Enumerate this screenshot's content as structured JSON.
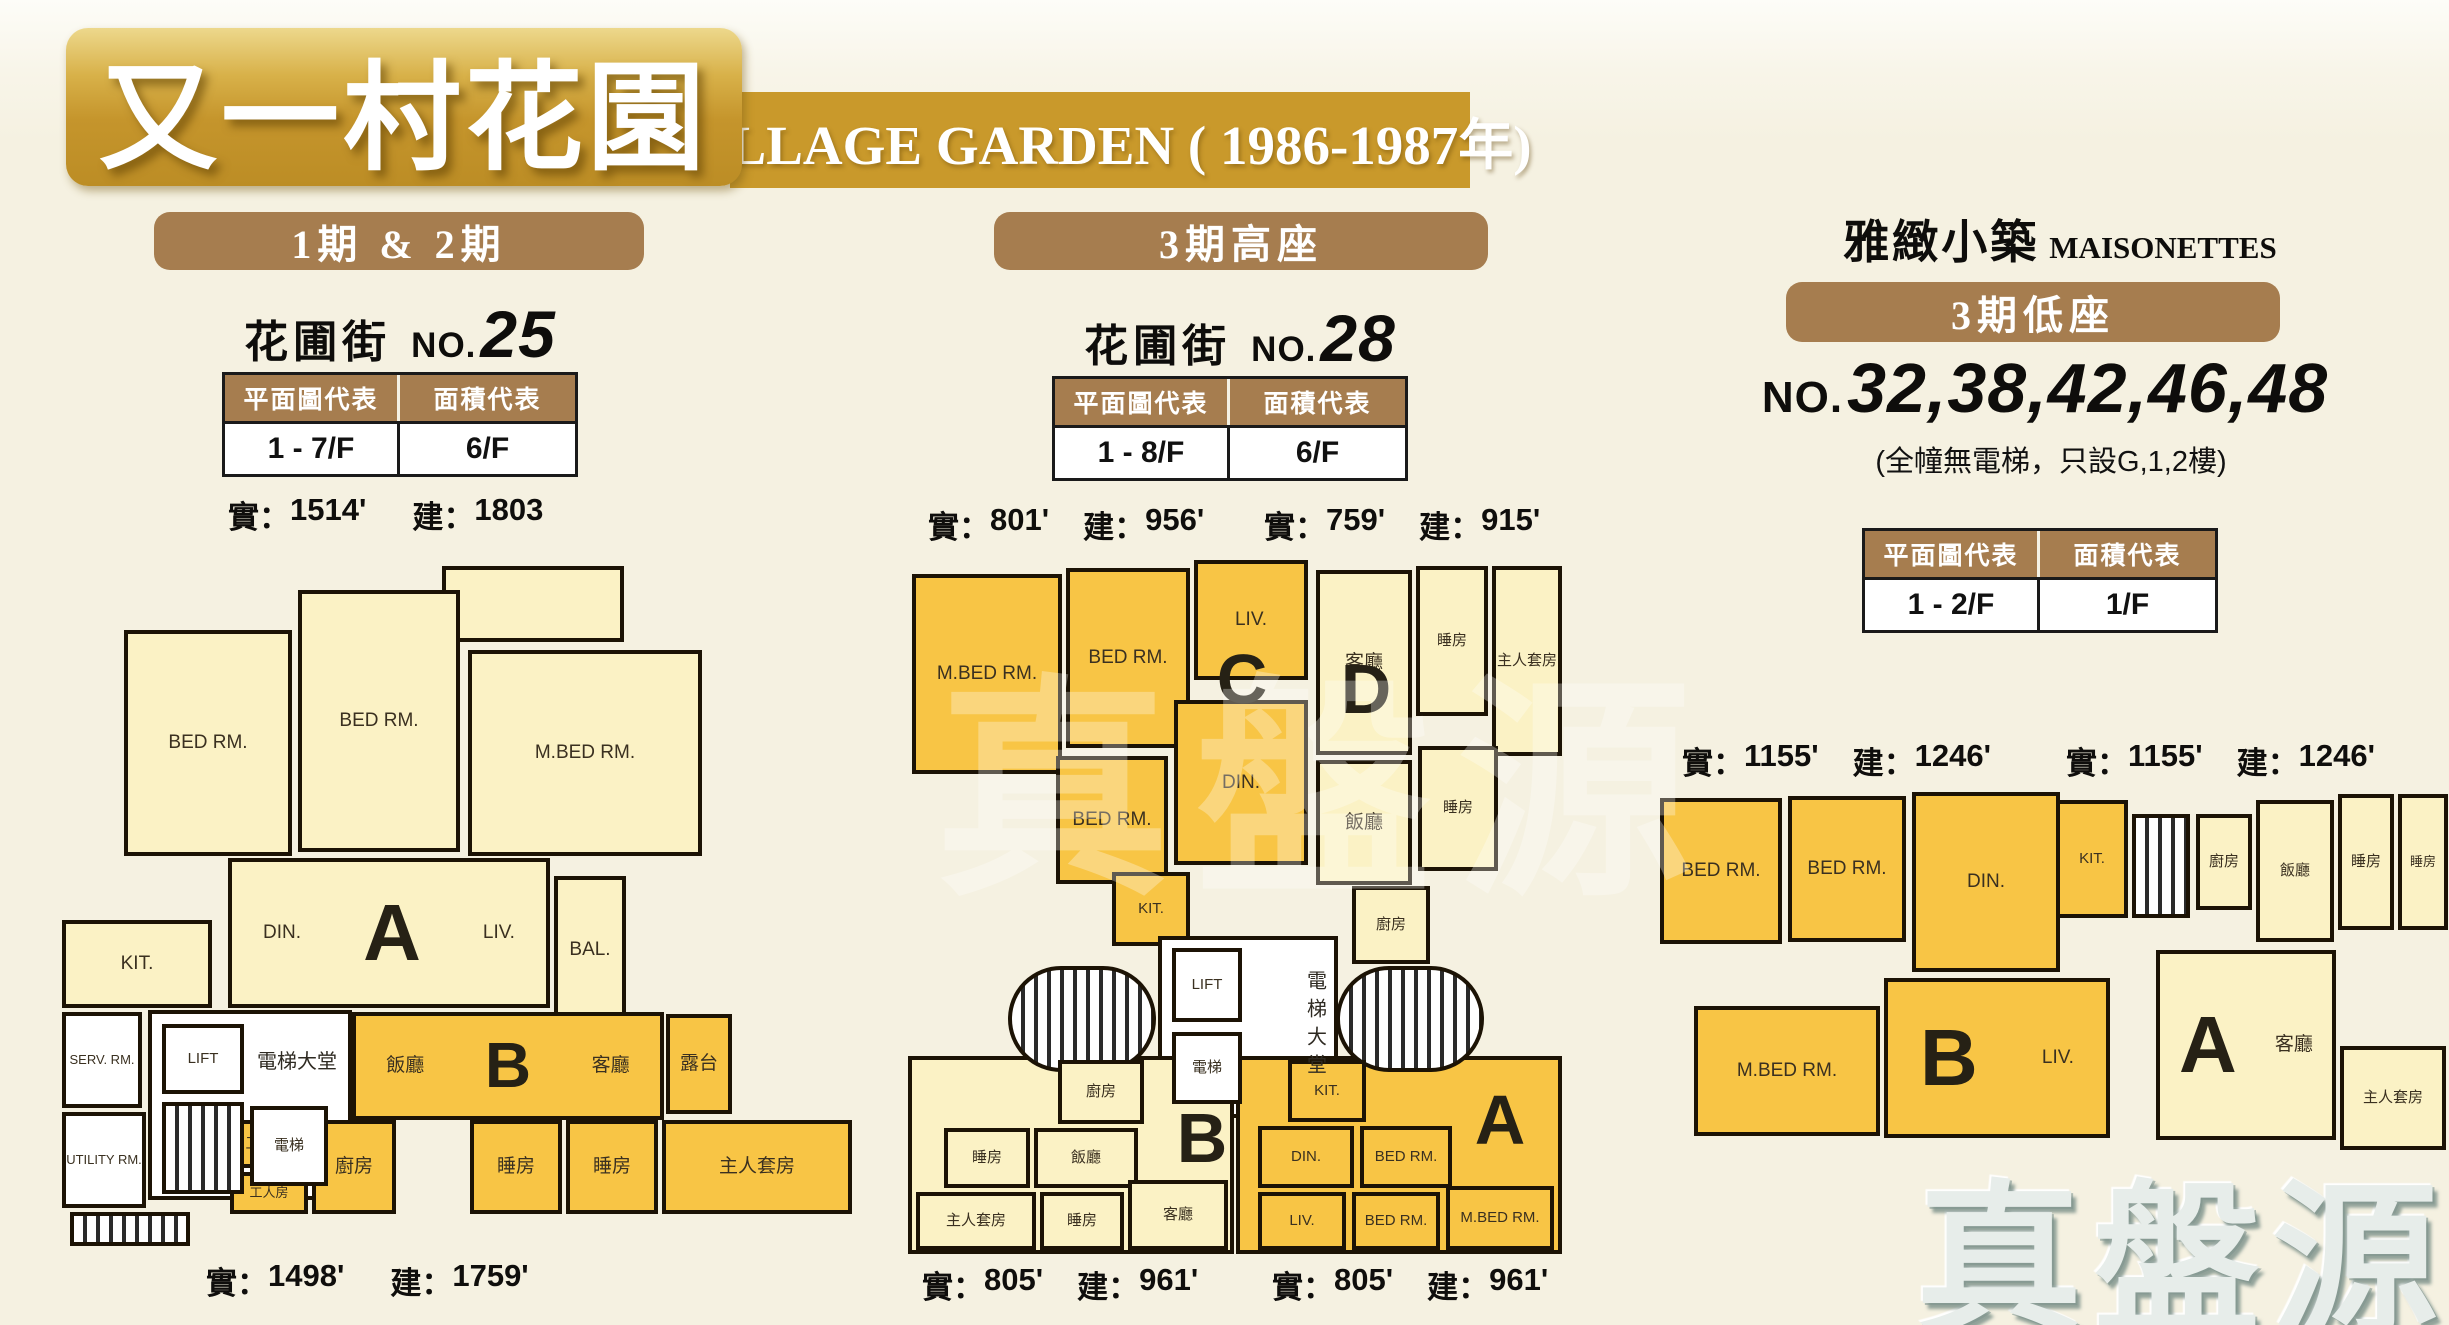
{
  "colors": {
    "gold_unit": "#F8C545",
    "cream_unit": "#FBF2C5",
    "banner_brown": "#A67D4F",
    "title_gold": "#C9992B"
  },
  "header": {
    "title_zh": "又一村花園",
    "title_en": "VILLAGE GARDEN ( 1986-1987年)"
  },
  "s1": {
    "banner": "1期 & 2期",
    "street": "花圃街",
    "no_label": "NO.",
    "no": "25",
    "th_plan": "平面圖代表",
    "th_area": "面積代表",
    "td_plan": "1 - 7/F",
    "td_area": "6/F",
    "k_act": "實：",
    "k_gross": "建：",
    "top_act": "1514'",
    "top_gross": "1803",
    "bot_act": "1498'",
    "bot_gross": "1759'"
  },
  "p1": {
    "letter_a": "A",
    "letter_b": "B",
    "a_bed1": "BED RM.",
    "a_bed2": "BED RM.",
    "a_mbed": "M.BED RM.",
    "a_din": "DIN.",
    "a_liv": "LIV.",
    "a_bal": "BAL.",
    "a_kit": "KIT.",
    "core_lift": "LIFT",
    "core_lobby": "電梯大堂",
    "core_lift2": "電梯",
    "serv": "SERV. RM.",
    "utility": "UTILITY RM.",
    "b_din": "飯廳",
    "b_liv": "客廳",
    "b_terrace": "露台",
    "b_work": "工作間",
    "b_kit": "廚房",
    "b_maid": "工人房",
    "b_bed1": "睡房",
    "b_bed2": "睡房",
    "b_msuite": "主人套房"
  },
  "s2": {
    "banner": "3期高座",
    "street": "花圃街",
    "no_label": "NO.",
    "no": "28",
    "th_plan": "平面圖代表",
    "th_area": "面積代表",
    "td_plan": "1 - 8/F",
    "td_area": "6/F",
    "k_act": "實：",
    "k_gross": "建：",
    "c_act": "801'",
    "c_gross": "956'",
    "d_act": "759'",
    "d_gross": "915'",
    "b_act": "805'",
    "b_gross": "961'",
    "a_act": "805'",
    "a_gross": "961'"
  },
  "p2": {
    "letter_c": "C",
    "letter_d": "D",
    "letter_a": "A",
    "letter_b": "B",
    "c_mbed": "M.BED RM.",
    "c_bed1": "BED RM.",
    "c_liv": "LIV.",
    "c_bed2": "BED RM.",
    "c_din": "DIN.",
    "c_kit": "KIT.",
    "d_liv": "客廳",
    "d_bed1": "睡房",
    "d_msuite": "主人套房",
    "d_din": "飯廳",
    "d_bed2": "睡房",
    "d_kit": "廚房",
    "core_lift": "LIFT",
    "core_lift2": "電梯",
    "core_lobby": "電梯大堂",
    "b_kit": "廚房",
    "b_bed1": "睡房",
    "b_din": "飯廳",
    "b_msuite": "主人套房",
    "b_bed2": "睡房",
    "b_liv": "客廳",
    "a_kit": "KIT.",
    "a_din": "DIN.",
    "a_bed1": "BED RM.",
    "a_liv": "LIV.",
    "a_bed2": "BED RM.",
    "a_mbed": "M.BED RM."
  },
  "s3": {
    "title_zh": "雅緻小築",
    "title_en": "MAISONETTES",
    "banner": "3期低座",
    "no_label": "NO.",
    "no": "32,38,42,46,48",
    "note": "(全幢無電梯，只設G,1,2樓)",
    "th_plan": "平面圖代表",
    "th_area": "面積代表",
    "td_plan": "1 - 2/F",
    "td_area": "1/F",
    "k_act": "實：",
    "k_gross": "建：",
    "b_act": "1155'",
    "b_gross": "1246'",
    "a_act": "1155'",
    "a_gross": "1246'"
  },
  "p3": {
    "letter_b": "B",
    "letter_a": "A",
    "b_bed1": "BED RM.",
    "b_bed2": "BED RM.",
    "b_din": "DIN.",
    "b_kit": "KIT.",
    "b_mbed": "M.BED RM.",
    "b_liv": "LIV.",
    "a_kit": "廚房",
    "a_din": "飯廳",
    "a_bed1": "睡房",
    "a_bed2": "睡房",
    "a_liv": "客廳",
    "a_msuite": "主人套房"
  },
  "watermark": {
    "brand": "真盤源"
  }
}
